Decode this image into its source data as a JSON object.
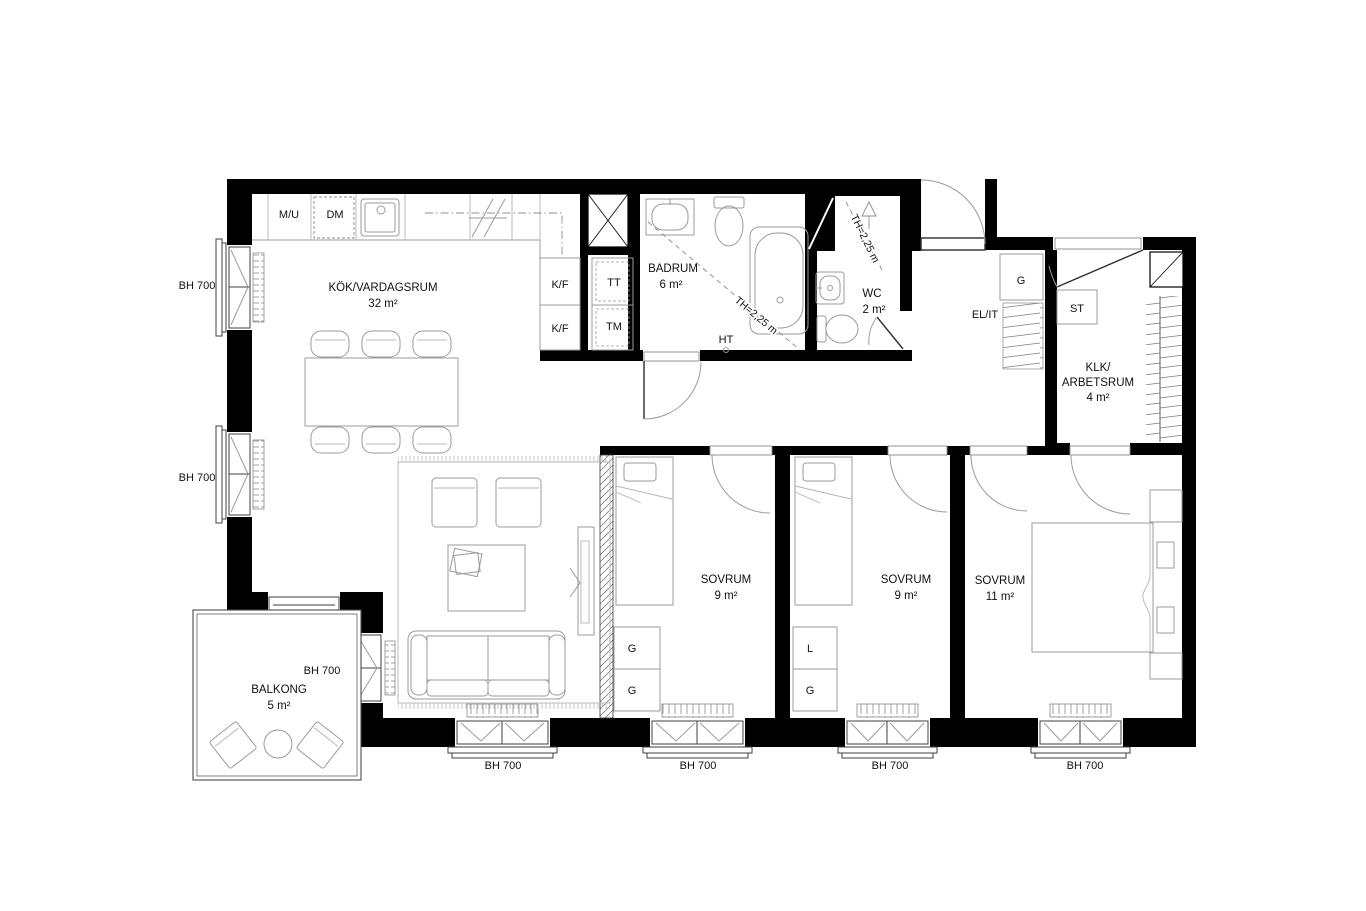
{
  "rooms": {
    "kitchen_living": {
      "name": "KÖK/VARDAGSRUM",
      "area": "32 m²"
    },
    "bathroom": {
      "name": "BADRUM",
      "area": "6 m²"
    },
    "wc": {
      "name": "WC",
      "area": "2 m²"
    },
    "klk_workroom": {
      "line1": "KLK/",
      "line2": "ARBETSRUM",
      "area": "4 m²"
    },
    "bedroom_1": {
      "name": "SOVRUM",
      "area": "9 m²"
    },
    "bedroom_2": {
      "name": "SOVRUM",
      "area": "9 m²"
    },
    "bedroom_3": {
      "name": "SOVRUM",
      "area": "11 m²"
    },
    "balcony": {
      "name": "BALKONG",
      "area": "5 m²"
    }
  },
  "labels": {
    "microwave_oven": "M/U",
    "dishwasher": "DM",
    "fridge_freezer": "K/F",
    "fridge_freezer_2": "K/F",
    "tumble_dryer": "TT",
    "washing_machine": "TM",
    "towel_dryer": "HT",
    "hall_wardrobe": "G",
    "electrical_it": "EL/IT",
    "cleaning_closet": "ST",
    "bedroom1_wardrobe_1": "G",
    "bedroom1_wardrobe_2": "G",
    "bedroom2_linen": "L",
    "bedroom2_wardrobe": "G"
  },
  "annotations": {
    "window_height": "BH 700",
    "door_height": "TH=2,25 m"
  }
}
